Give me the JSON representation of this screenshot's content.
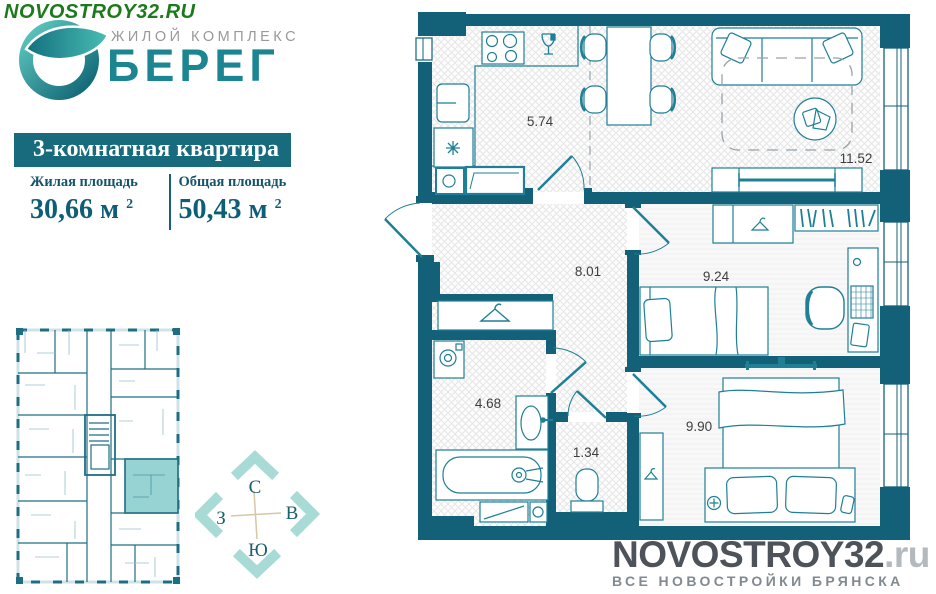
{
  "site": {
    "url": "NOVOSTROY32.RU"
  },
  "logo": {
    "complex_label": "ЖИЛОЙ КОМПЛЕКС",
    "name": "БЕРЕГ"
  },
  "apartment": {
    "title": "3-комнатная квартира",
    "living_area": {
      "label": "Жилая площадь",
      "value": "30,66 м",
      "sup": "2"
    },
    "total_area": {
      "label": "Общая площадь",
      "value": "50,43 м",
      "sup": "2"
    }
  },
  "compass": {
    "north": "С",
    "east": "В",
    "south": "Ю",
    "west": "З"
  },
  "floor_plan": {
    "rooms": [
      {
        "id": "kitchen",
        "area": "5.74"
      },
      {
        "id": "living-room",
        "area": "11.52"
      },
      {
        "id": "hallway",
        "area": "8.01"
      },
      {
        "id": "bedroom-1",
        "area": "9.24"
      },
      {
        "id": "bathroom",
        "area": "4.68"
      },
      {
        "id": "wc",
        "area": "1.34"
      },
      {
        "id": "bedroom-2",
        "area": "9.90"
      }
    ]
  },
  "watermark": {
    "brand": "NOVOSTROY32",
    "domain": ".ru",
    "tagline": "ВСЕ НОВОСТРОЙКИ БРЯНСКА"
  },
  "colors": {
    "wall": "#136179",
    "accent": "#186b7d",
    "highlight": "#98d3d3",
    "compass_arrow": "#a8dbd6",
    "site_green": "#1c7a1c",
    "logo_teal": "#1b8591"
  }
}
